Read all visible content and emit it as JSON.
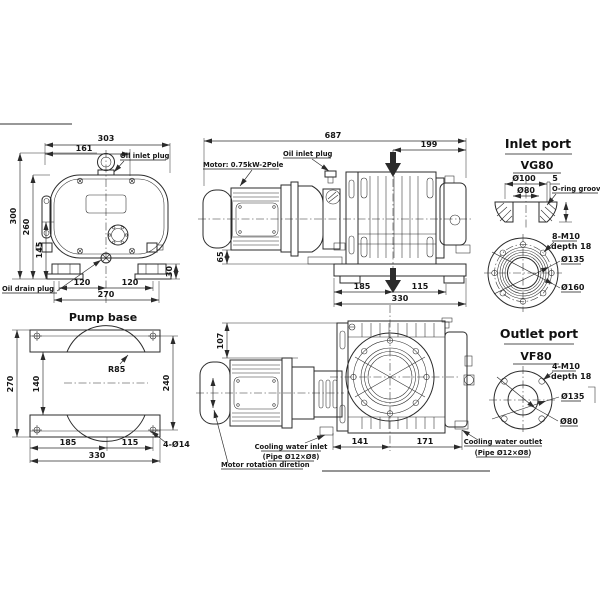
{
  "drawing": {
    "background": "#ffffff",
    "line_color": "#2b2b2b",
    "front_view": {
      "labels": {
        "oil_inlet": "Oil inlet plug",
        "oil_drain": "Oil drain plug"
      },
      "dims": {
        "d303": "303",
        "d161": "161",
        "d300": "300",
        "d260": "260",
        "d145": "145",
        "d120a": "120",
        "d120b": "120",
        "d270": "270",
        "d30": "30"
      }
    },
    "side_view": {
      "labels": {
        "motor_spec": "Motor: 0.75kW-2Pole",
        "oil_inlet": "Oil inlet plug"
      },
      "dims": {
        "d687": "687",
        "d199": "199",
        "d65": "65",
        "d185": "185",
        "d115": "115",
        "d330": "330"
      }
    },
    "inlet_port": {
      "title": "Inlet port",
      "size": "VG80",
      "labels": {
        "oring": "O-ring groove"
      },
      "dims": {
        "d100": "Ø100",
        "d80": "Ø80",
        "d5": "5",
        "bolts": "8-M10",
        "depth": "depth 18",
        "d135": "Ø135",
        "d160": "Ø160"
      }
    },
    "outlet_port": {
      "title": "Outlet port",
      "size": "VF80",
      "dims": {
        "bolts": "4-M10",
        "depth": "depth 18",
        "d135": "Ø135",
        "d80": "Ø80"
      }
    },
    "pump_base": {
      "title": "Pump base",
      "dims": {
        "d270": "270",
        "d140": "140",
        "d240": "240",
        "r85": "R85",
        "d185": "185",
        "d115": "115",
        "d330": "330",
        "holes": "4-Ø14"
      }
    },
    "plan_view": {
      "labels": {
        "cool_in": "Cooling water inlet",
        "cool_in_pipe": "(Pipe Ø12×Ø8)",
        "rotation": "Motor rotation diretion",
        "cool_out": "Cooling water outlet",
        "cool_out_pipe": "(Pipe Ø12×Ø8)"
      },
      "dims": {
        "d107": "107",
        "d141": "141",
        "d171": "171"
      }
    }
  }
}
